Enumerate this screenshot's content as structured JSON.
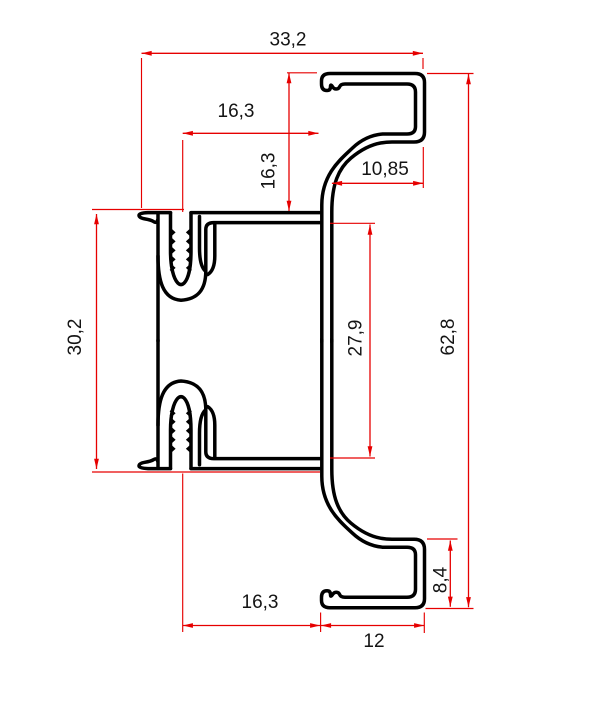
{
  "drawing": {
    "title": "aluminium-profile-cross-section",
    "background_color": "#ffffff",
    "profile_line_color": "#000000",
    "dimension_line_color": "#e60000",
    "dimension_text_color": "#141414",
    "dimensions": [
      {
        "id": "overall-width-top",
        "label": "33,2",
        "orientation": "horizontal"
      },
      {
        "id": "slot-to-hook-top",
        "label": "16,3",
        "orientation": "horizontal"
      },
      {
        "id": "hook-height-above-body",
        "label": "16,3",
        "orientation": "vertical"
      },
      {
        "id": "top-hook-opening-width",
        "label": "10,85",
        "orientation": "horizontal"
      },
      {
        "id": "body-height",
        "label": "30,2",
        "orientation": "vertical"
      },
      {
        "id": "inner-cavity-height",
        "label": "27,9",
        "orientation": "vertical"
      },
      {
        "id": "overall-height",
        "label": "62,8",
        "orientation": "vertical"
      },
      {
        "id": "bottom-hook-height",
        "label": "8,4",
        "orientation": "vertical"
      },
      {
        "id": "slot-to-hook-bottom",
        "label": "16,3",
        "orientation": "horizontal"
      },
      {
        "id": "bottom-hook-width",
        "label": "12",
        "orientation": "horizontal"
      }
    ]
  }
}
